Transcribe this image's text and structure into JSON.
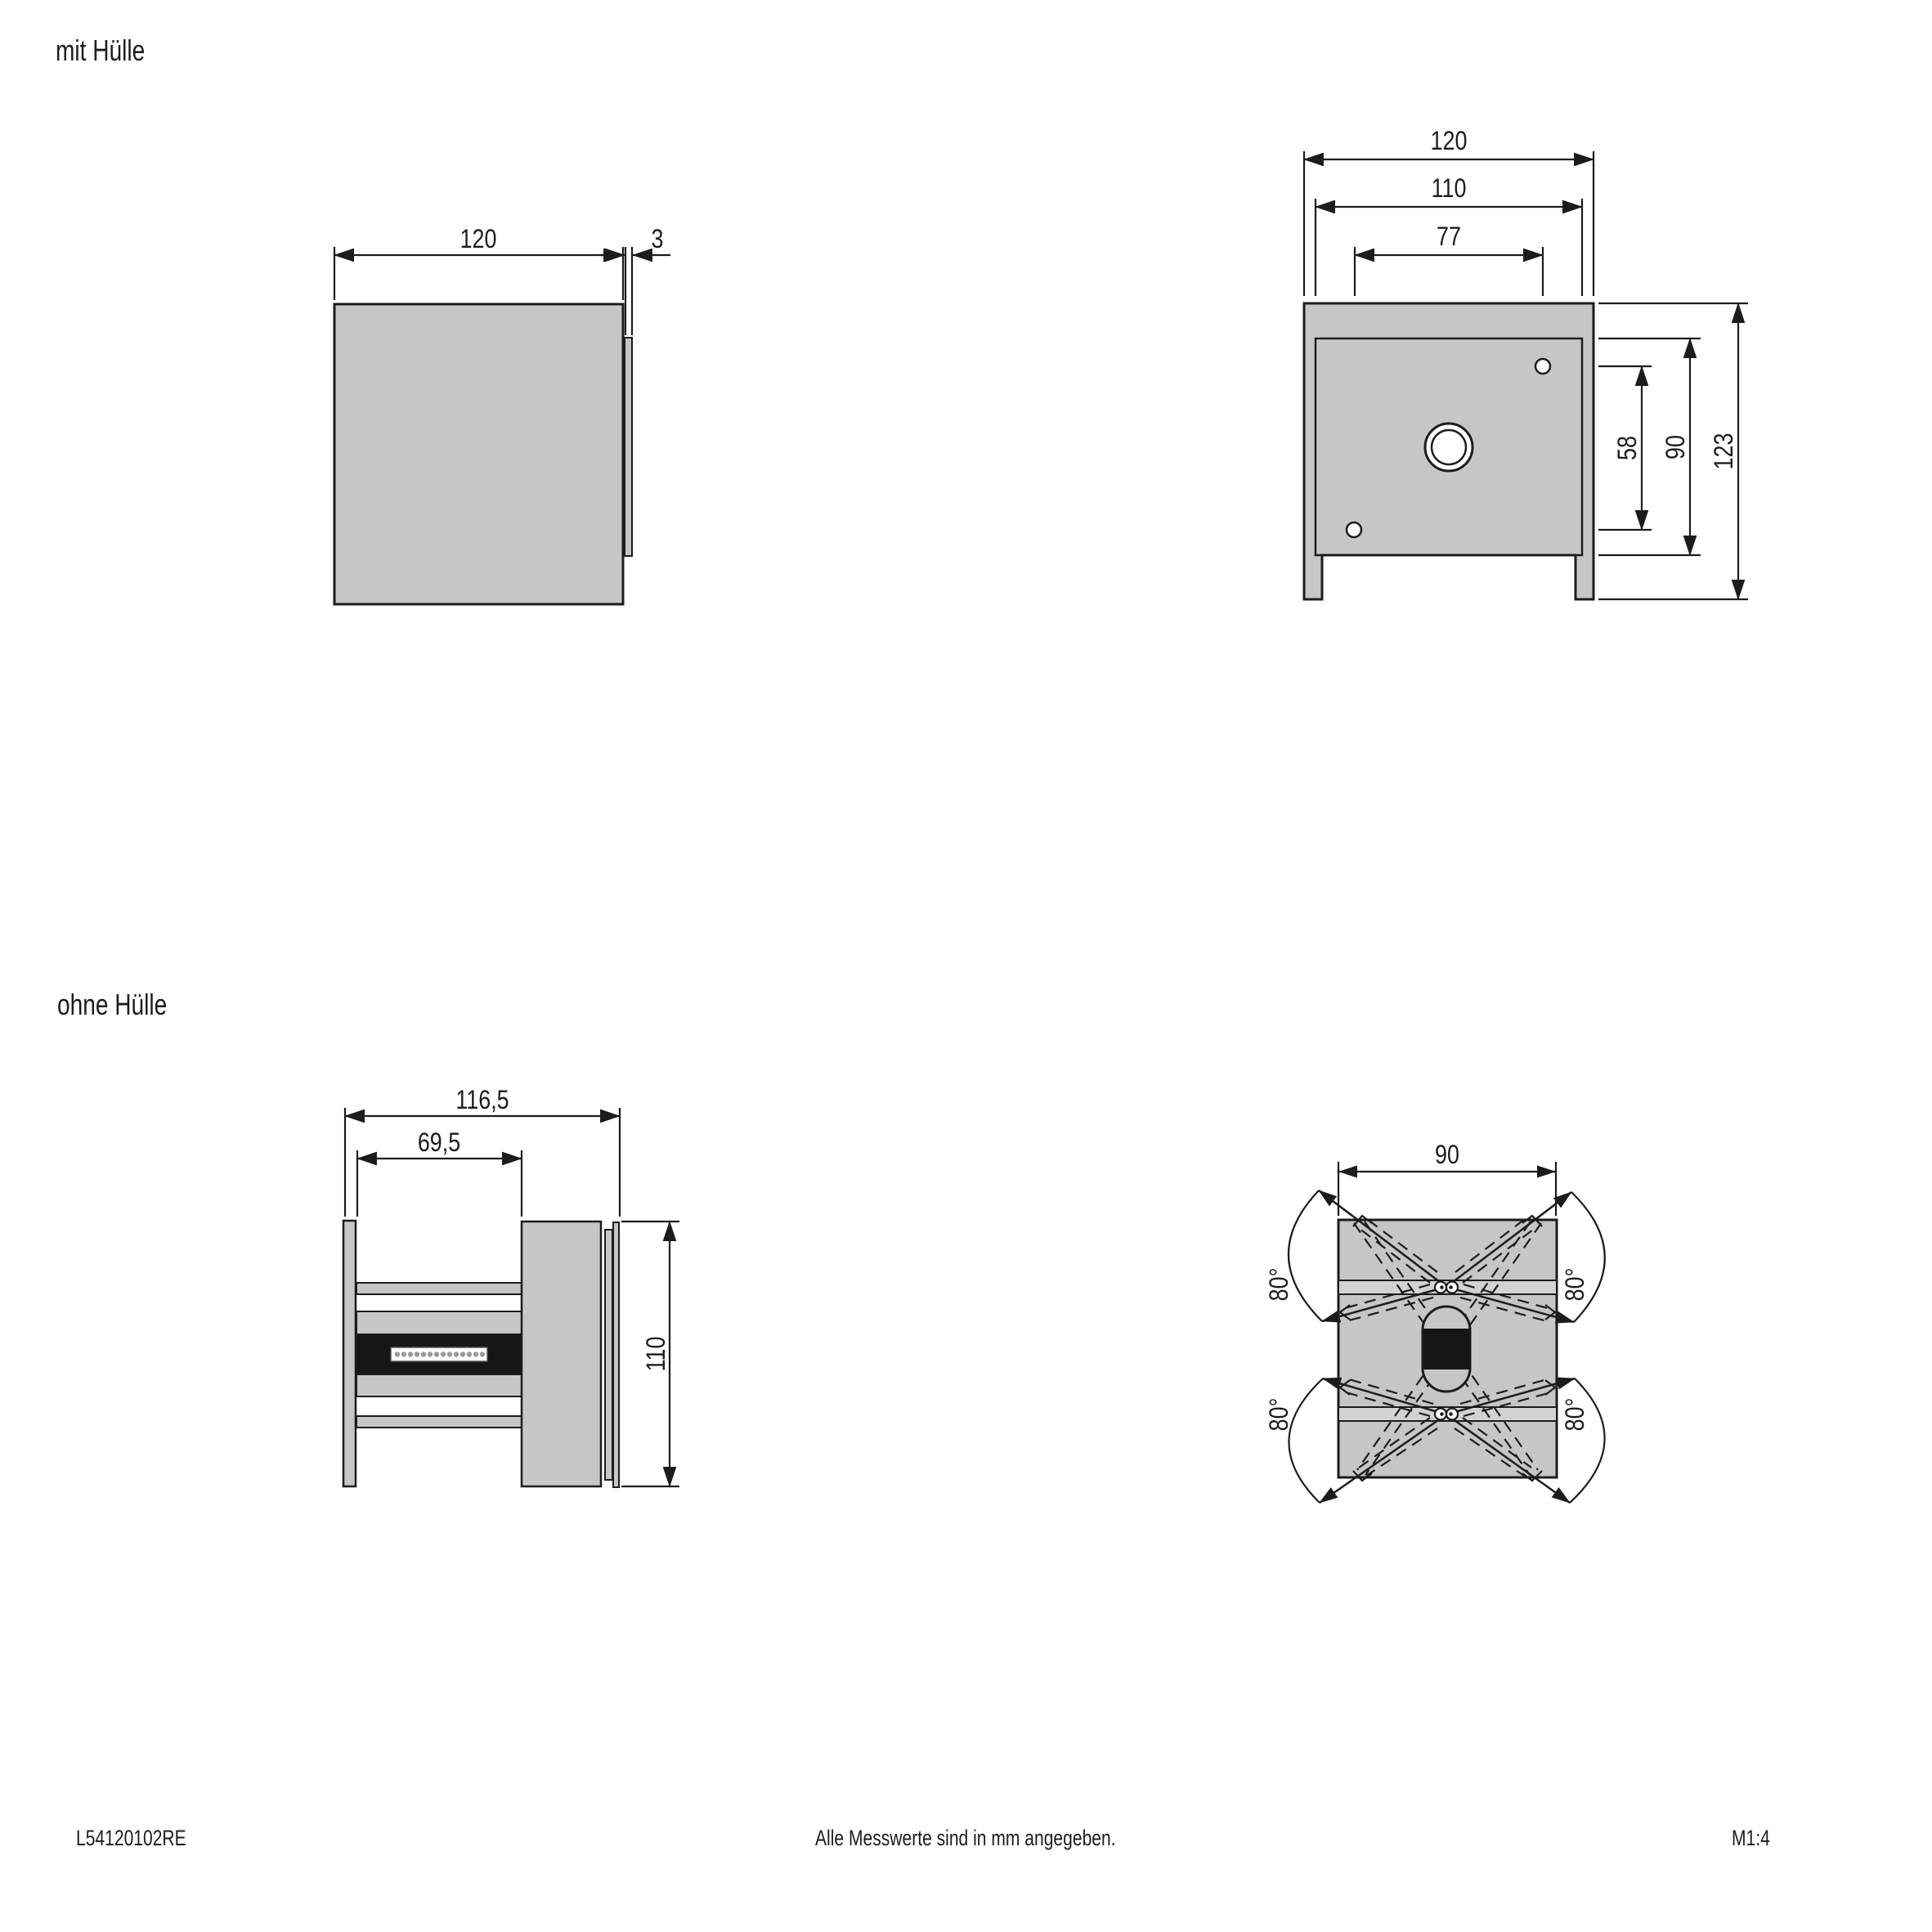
{
  "labels": {
    "with_cover": "mit Hülle",
    "without_cover": "ohne Hülle"
  },
  "footer": {
    "drawing_number": "L54120102RE",
    "note": "Alle Messwerte sind in mm angegeben.",
    "scale": "M1:4"
  },
  "colors": {
    "line": "#1c1c1c",
    "fill": "#c6c6c6",
    "band_fill": "#d2d2d2",
    "black_part": "#161616"
  },
  "views": {
    "front_with_cover": {
      "width": "120",
      "cover_thickness": "3"
    },
    "back_with_cover": {
      "width": "120",
      "inner_width": "110",
      "hole_spacing_width": "77",
      "hole_spacing_height": "58",
      "inner_height": "90",
      "height": "123"
    },
    "side_without_cover": {
      "depth": "116,5",
      "inner_depth": "69,5",
      "height": "110"
    },
    "back_without_cover": {
      "width": "90",
      "swivel_top_left": "80°",
      "swivel_top_right": "80°",
      "swivel_bottom_left": "80°",
      "swivel_bottom_right": "80°"
    }
  }
}
